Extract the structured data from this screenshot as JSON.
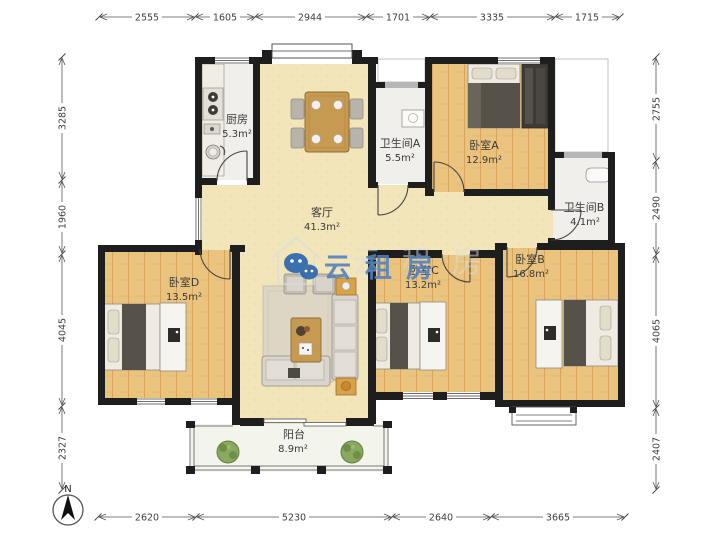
{
  "watermark": {
    "text": "云租房",
    "color": "#4e80c0",
    "logo_icon": "chat-bubbles-logo"
  },
  "compass": {
    "label": "N",
    "icon": "north-arrow"
  },
  "rooms": [
    {
      "name": "厨房",
      "area": "5.3m²"
    },
    {
      "name": "卫生间A",
      "area": "5.5m²"
    },
    {
      "name": "卧室A",
      "area": "12.9m²"
    },
    {
      "name": "卫生间B",
      "area": "4.1m²"
    },
    {
      "name": "客厅",
      "area": "41.3m²"
    },
    {
      "name": "卧室C",
      "area": "13.2m²"
    },
    {
      "name": "卧室B",
      "area": "16.8m²"
    },
    {
      "name": "卧室D",
      "area": "13.5m²"
    },
    {
      "name": "阳台",
      "area": "8.9m²"
    }
  ],
  "dims": {
    "top": [
      "2555",
      "1605",
      "2944",
      "1701",
      "3335",
      "1715"
    ],
    "left": [
      "3285",
      "1960",
      "4045",
      "2327"
    ],
    "right": [
      "2755",
      "2490",
      "4065",
      "2407"
    ],
    "bottom": [
      "2620",
      "5230",
      "2640",
      "3665"
    ]
  },
  "colors": {
    "wall": "#1e1e1e",
    "wood_floor": "#eac47e",
    "living_floor": "#f3e5ba",
    "tile_floor": "#f0efeb",
    "balcony_floor": "#f3f5ec",
    "watermark_blue": "#4e80c0",
    "plant_green": "#8aa95e"
  }
}
